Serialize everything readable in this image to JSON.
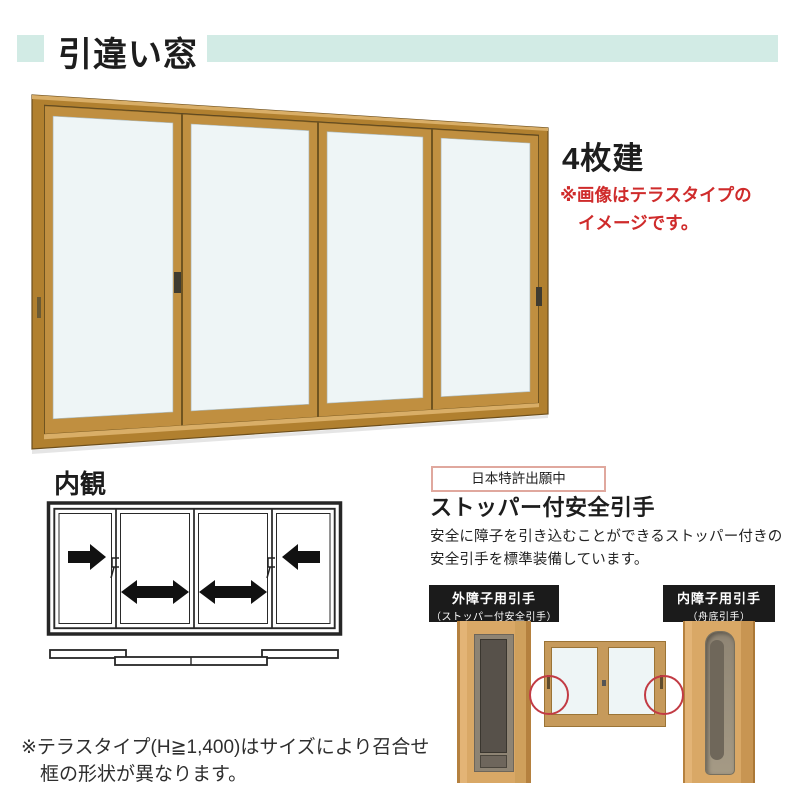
{
  "header": {
    "title": "引違い窓"
  },
  "main_illustration": {
    "label": "4枚建",
    "note_lines": [
      "※画像はテラスタイプの",
      "イメージです。"
    ]
  },
  "interior_view": {
    "title": "内観"
  },
  "feature": {
    "patent_badge": "日本特許出願中",
    "title": "ストッパー付安全引手",
    "description_lines": [
      "安全に障子を引き込むことができるストッパー付きの",
      "安全引手を標準装備しています。"
    ],
    "labels": [
      {
        "line1": "外障子用引手",
        "line2": "（ストッパー付安全引手）"
      },
      {
        "line1": "内障子用引手",
        "line2": "（舟底引手）"
      }
    ]
  },
  "footer_note": {
    "lines": [
      "※テラスタイプ(H≧1,400)はサイズにより召合せ",
      "框の形状が異なります。"
    ]
  },
  "colors": {
    "accent": "#d2ebe5",
    "note_red": "#cf2b2b",
    "frame": "#c08f40",
    "frame_dark": "#b1802f",
    "frame_light": "#d9ae67",
    "glass": "#eef5f6",
    "wood": "#c69a5b",
    "label_bg": "#1b1b1b",
    "circle_red": "#c23b44"
  }
}
